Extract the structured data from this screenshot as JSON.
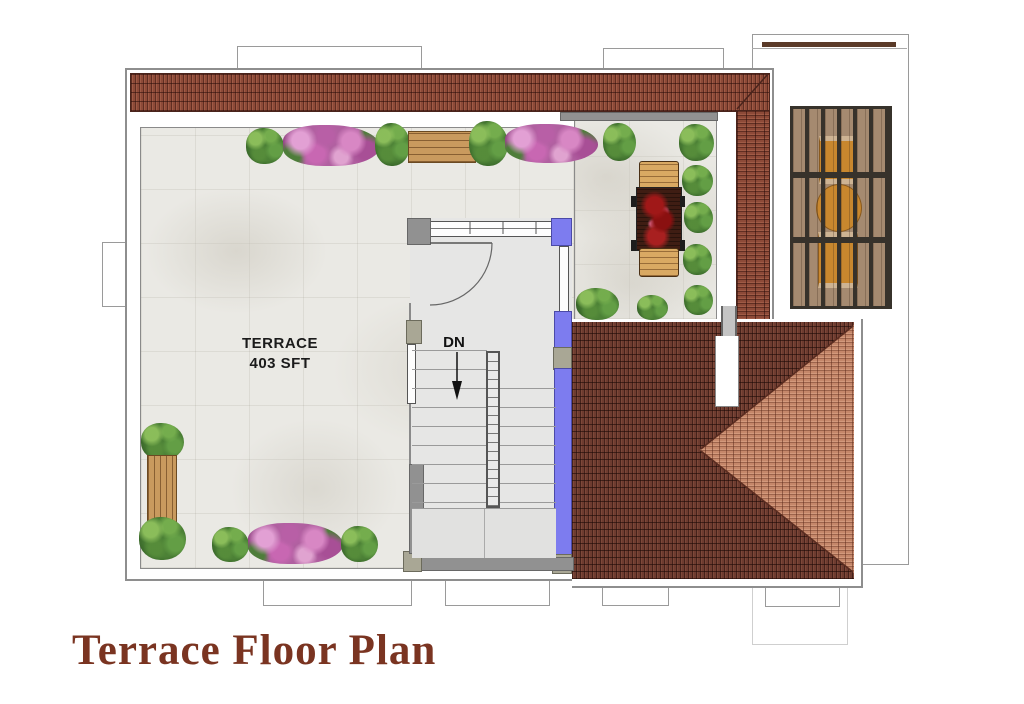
{
  "title": "Terrace Floor Plan",
  "plan": {
    "terrace_label_line1": "TERRACE",
    "terrace_label_line2": "403 SFT",
    "stairs_direction_label": "DN"
  },
  "colors": {
    "brick": "#8d4a38",
    "brick_dark": "#4a241c",
    "roof_dark": "#6e3c30",
    "roof_light": "#c5876a",
    "wall_blue": "#7d7cef",
    "wall_gray": "#919191",
    "column_olive": "#a9a795",
    "floor_marble": "#eae9e4",
    "stair_floor": "#e6e6e5",
    "wood_bench": "#c99a5e",
    "pergola_wood": "#a58a70",
    "pergola_beam": "#37322b",
    "patio_furniture": "#c8872e",
    "dining_table": "#3f1d13",
    "plant_green": "#3f7030",
    "flower_pink": "#b060a0",
    "title_text": "#7a3421"
  }
}
